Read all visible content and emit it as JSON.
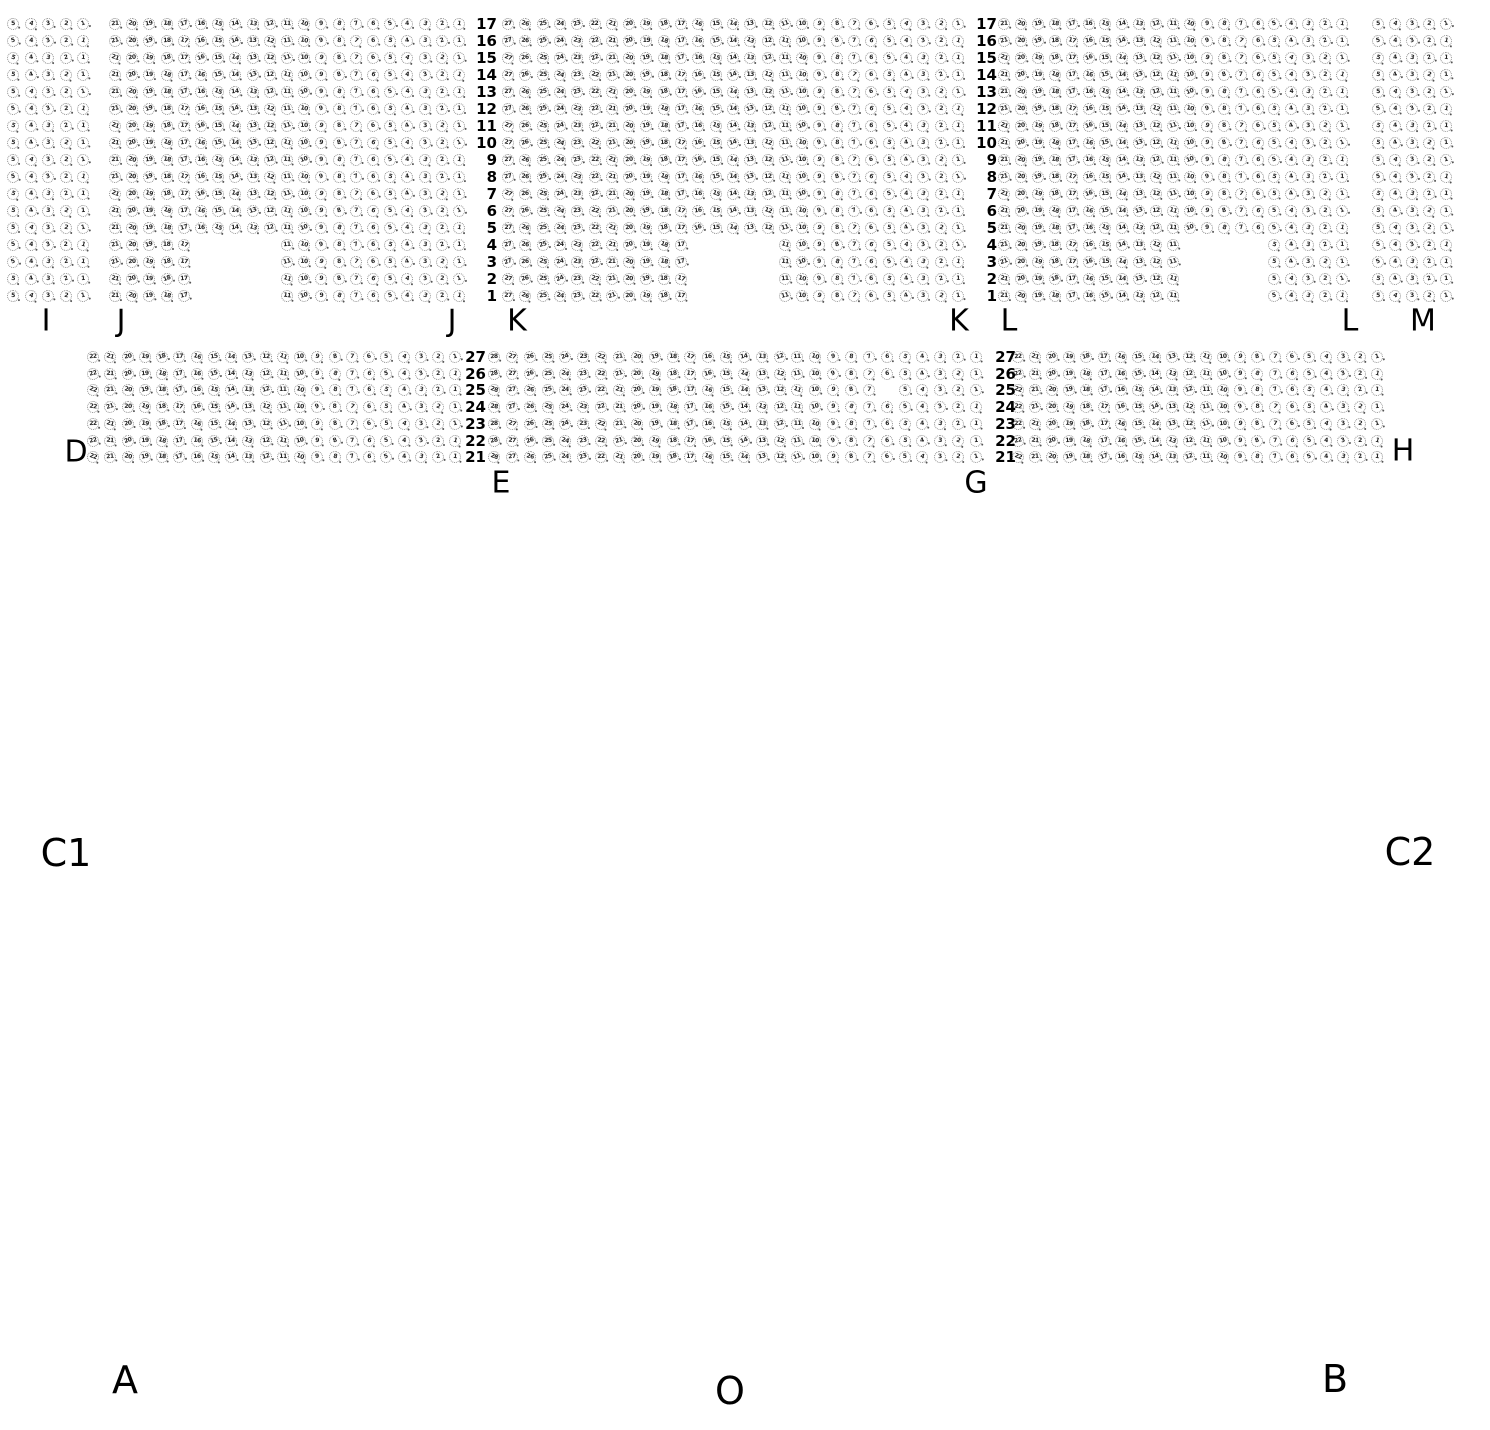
{
  "seat_style": {
    "diameter": 12,
    "border_color": "#8f8f8f",
    "glyph_color": "#222222",
    "dot_color": "#555555",
    "background": "#ffffff"
  },
  "row_sets": {
    "top": [
      "17",
      "16",
      "15",
      "14",
      "13",
      "12",
      "11",
      "10",
      "9",
      "8",
      "7",
      "6",
      "5",
      "4",
      "3",
      "2",
      "1"
    ],
    "mid": [
      "27",
      "26",
      "25",
      "24",
      "23",
      "22",
      "21"
    ]
  },
  "sections": [
    {
      "name": "I",
      "rows_ref": "top",
      "origin_x": 13,
      "origin_y": 24,
      "cols": 5,
      "pitch_x": 17.5,
      "pitch_y": 17.0,
      "notch": null,
      "missing": [],
      "labels": [
        {
          "text": "I",
          "x": 46,
          "y": 321
        }
      ]
    },
    {
      "name": "J",
      "rows_ref": "top",
      "origin_x": 115,
      "origin_y": 24,
      "cols": 21,
      "pitch_x": 17.2,
      "pitch_y": 17.0,
      "notch": {
        "rows": [
          "4",
          "3",
          "2",
          "1"
        ],
        "col_start": 6,
        "col_end": 10
      },
      "missing": [],
      "labels": [
        {
          "text": "J",
          "x": 121,
          "y": 321
        },
        {
          "text": "J",
          "x": 452,
          "y": 321
        }
      ]
    },
    {
      "name": "K",
      "rows_ref": "top",
      "origin_x": 508,
      "origin_y": 24,
      "cols": 27,
      "pitch_x": 17.3,
      "pitch_y": 17.0,
      "notch": {
        "rows": [
          "4",
          "3",
          "2",
          "1"
        ],
        "col_start": 12,
        "col_end": 16
      },
      "missing": [],
      "labels": [
        {
          "text": "K",
          "x": 517,
          "y": 321
        },
        {
          "text": "K",
          "x": 959,
          "y": 321
        }
      ]
    },
    {
      "name": "L",
      "rows_ref": "top",
      "origin_x": 1004,
      "origin_y": 24,
      "cols": 21,
      "pitch_x": 16.9,
      "pitch_y": 17.0,
      "notch": {
        "rows": [
          "4",
          "3",
          "2",
          "1"
        ],
        "col_start": 12,
        "col_end": 16
      },
      "missing": [],
      "labels": [
        {
          "text": "L",
          "x": 1009,
          "y": 321
        },
        {
          "text": "L",
          "x": 1350,
          "y": 321
        }
      ]
    },
    {
      "name": "M",
      "rows_ref": "top",
      "origin_x": 1378,
      "origin_y": 24,
      "cols": 5,
      "pitch_x": 17.0,
      "pitch_y": 17.0,
      "notch": null,
      "missing": [],
      "labels": [
        {
          "text": "M",
          "x": 1423,
          "y": 321
        }
      ]
    },
    {
      "name": "DE",
      "rows_ref": "mid",
      "origin_x": 93,
      "origin_y": 357,
      "cols": 22,
      "pitch_x": 17.25,
      "pitch_y": 16.7,
      "notch": null,
      "missing": [],
      "labels": [
        {
          "text": "D",
          "x": 76,
          "y": 452
        }
      ]
    },
    {
      "name": "EG",
      "rows_ref": "mid",
      "origin_x": 494,
      "origin_y": 357,
      "cols": 28,
      "pitch_x": 17.85,
      "pitch_y": 16.7,
      "notch": null,
      "missing": [
        {
          "row": "25",
          "col": 23
        }
      ],
      "labels": [
        {
          "text": "E",
          "x": 501,
          "y": 483
        },
        {
          "text": "G",
          "x": 976,
          "y": 483
        }
      ]
    },
    {
      "name": "GH",
      "rows_ref": "mid",
      "origin_x": 1018,
      "origin_y": 357,
      "cols": 22,
      "pitch_x": 17.1,
      "pitch_y": 16.7,
      "notch": null,
      "missing": [],
      "labels": [
        {
          "text": "H",
          "x": 1403,
          "y": 451
        }
      ]
    }
  ],
  "row_number_columns": [
    {
      "rows_ref": "top",
      "x_right": 497,
      "origin_y": 24,
      "pitch_y": 17.0
    },
    {
      "rows_ref": "top",
      "x_right": 997,
      "origin_y": 24,
      "pitch_y": 17.0
    },
    {
      "rows_ref": "mid",
      "x_right": 486,
      "origin_y": 357,
      "pitch_y": 16.7
    },
    {
      "rows_ref": "mid",
      "x_right": 1016,
      "origin_y": 357,
      "pitch_y": 16.7
    }
  ],
  "floor_labels": [
    {
      "text": "C1",
      "x": 66,
      "y": 853
    },
    {
      "text": "C2",
      "x": 1410,
      "y": 852
    },
    {
      "text": "A",
      "x": 125,
      "y": 1380
    },
    {
      "text": "O",
      "x": 730,
      "y": 1391
    },
    {
      "text": "B",
      "x": 1335,
      "y": 1379
    }
  ]
}
